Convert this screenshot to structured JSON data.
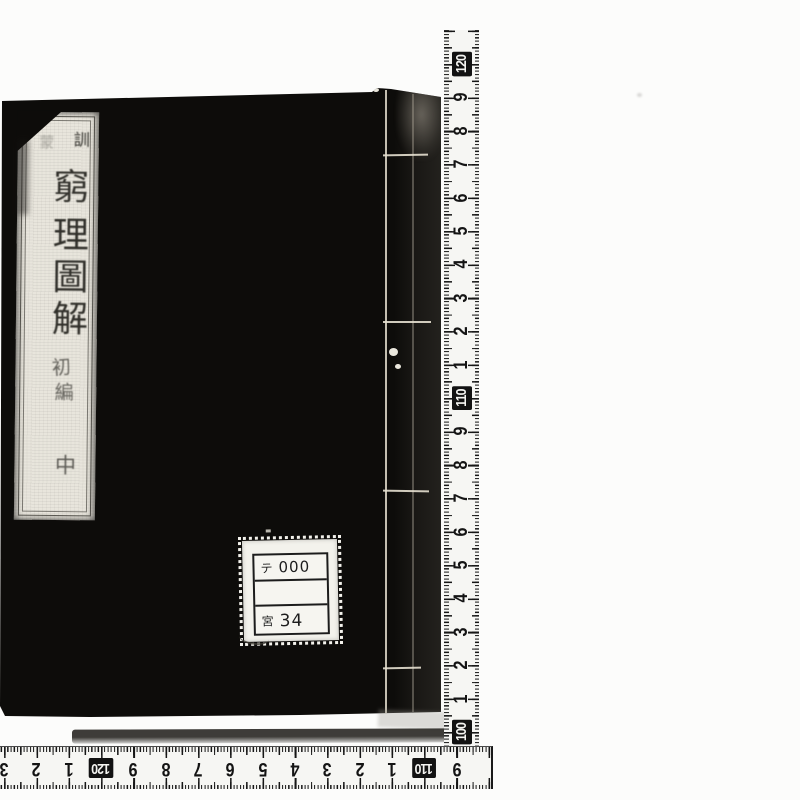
{
  "photo": {
    "background_color": "#fcfcfb",
    "book": {
      "cover_color": "#0d0c0a",
      "title_label": {
        "header_chars": [
          "訓",
          "蒙"
        ],
        "title_chars": [
          "窮",
          "理",
          "圖",
          "解"
        ],
        "edition_chars": [
          "初",
          "編"
        ],
        "volume_char": "中"
      },
      "call_number_label": {
        "row1_left": "テ",
        "row1_right": "000",
        "row2": "",
        "row3_left": "宮",
        "row3_right": "34"
      }
    },
    "rulers": {
      "tick_color": "#161616",
      "tape_color": "#f6f6f3",
      "vertical_labels": [
        "120",
        "9",
        "8",
        "7",
        "6",
        "5",
        "4",
        "3",
        "2",
        "1",
        "110",
        "9",
        "8",
        "7",
        "6",
        "5",
        "4",
        "3",
        "2",
        "1",
        "100"
      ],
      "horizontal_labels": [
        "3",
        "2",
        "1",
        "120",
        "9",
        "8",
        "7",
        "6",
        "5",
        "4",
        "3",
        "2",
        "1",
        "110",
        "9"
      ]
    }
  }
}
